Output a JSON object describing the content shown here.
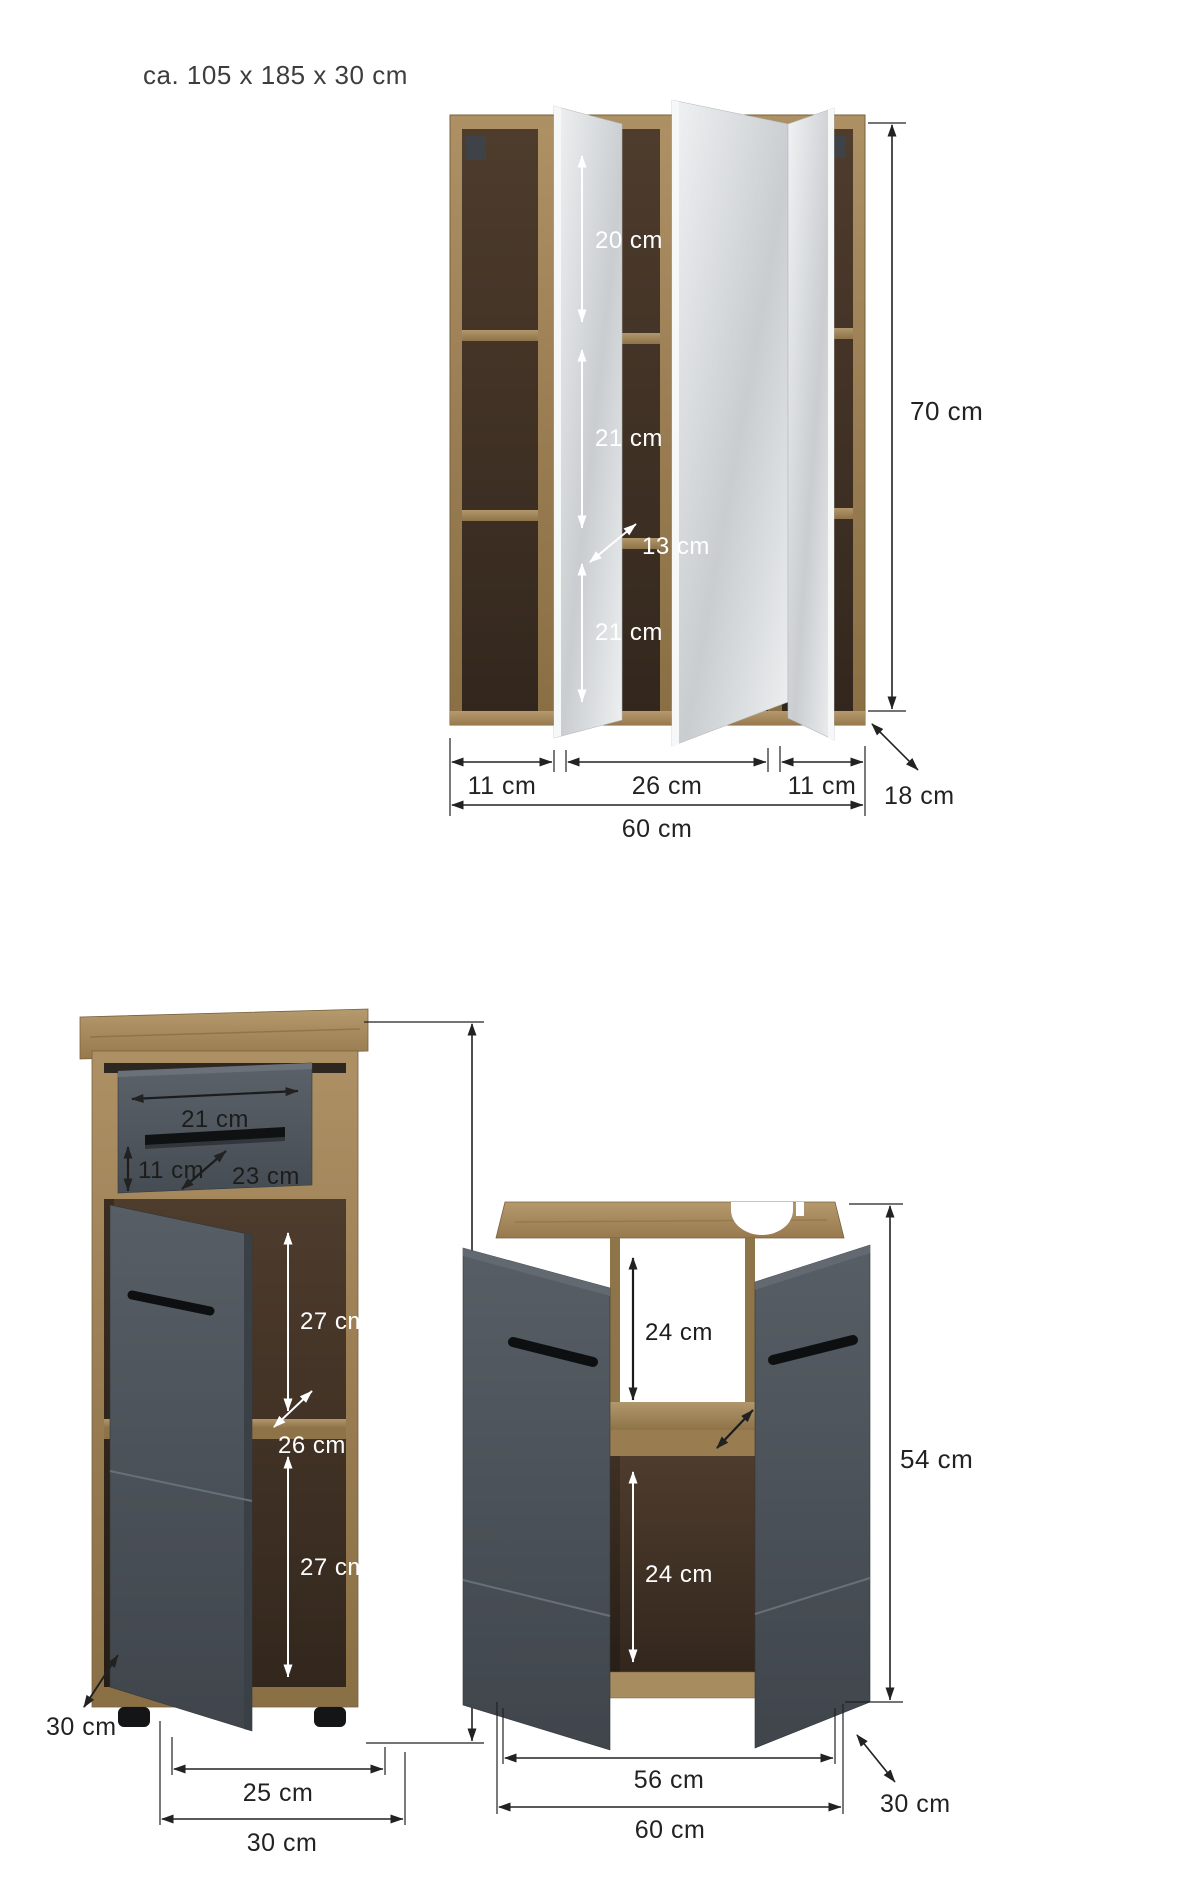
{
  "title": "ca. 105 x 185 x 30 cm",
  "mirror_cabinet": {
    "shelf_top_height": "20 cm",
    "shelf_middle_height": "21 cm",
    "shelf_depth": "13 cm",
    "shelf_bottom_height": "21 cm",
    "height": "70 cm",
    "left_section_width": "11 cm",
    "center_section_width": "26 cm",
    "right_section_width": "11 cm",
    "depth": "18 cm",
    "width": "60 cm"
  },
  "base_cabinet": {
    "drawer_inner_width": "21 cm",
    "drawer_inner_height": "11 cm",
    "drawer_inner_depth": "23 cm",
    "compartment_top_height": "27 cm",
    "shelf_depth": "26 cm",
    "compartment_bottom_height": "27 cm",
    "height": "80 cm",
    "depth": "30 cm",
    "door_width": "25 cm",
    "width": "30 cm"
  },
  "washbasin_cabinet": {
    "compartment_top_height": "24 cm",
    "shelf_depth": "28 cm",
    "compartment_bottom_height": "24 cm",
    "height": "54 cm",
    "inner_width": "56 cm",
    "depth": "30 cm",
    "width": "60 cm"
  },
  "colors": {
    "wood": "#a1875d",
    "wood_interior": "#46362a",
    "anthracite": "#4c5258",
    "mirror": "#dfe2e4",
    "dimension_line": "#222222",
    "label_white": "#ffffff"
  }
}
